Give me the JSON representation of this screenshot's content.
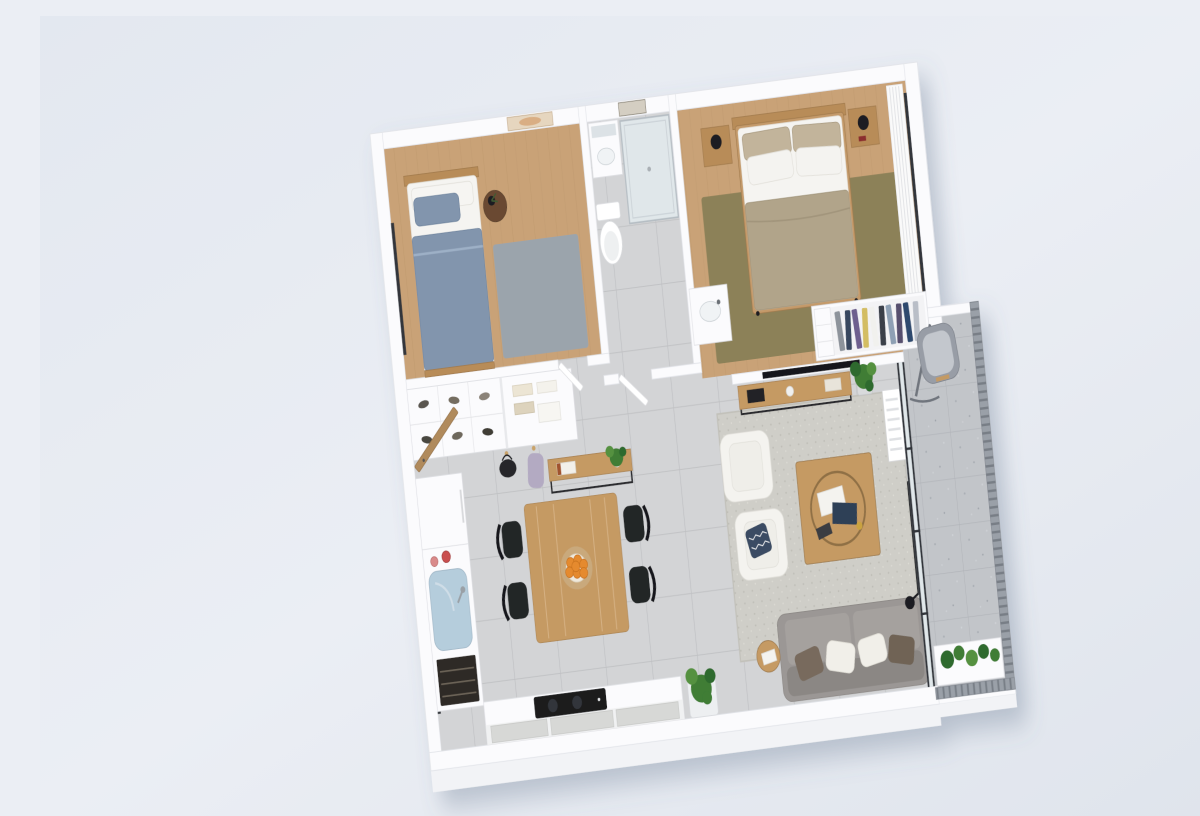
{
  "scene": {
    "description": "3D rendered isometric floor plan of a two-bedroom apartment with balcony, viewed from above on a pale blue-gray background",
    "view": "top-down axonometric, plan rotated slightly counter-clockwise",
    "rooms": [
      {
        "name": "Small bedroom",
        "position": "top-left",
        "floor": "light wood",
        "contents": [
          "single bed with blue-gray blanket and pillow",
          "wood headboard",
          "round dark-wood side table with black vase plant",
          "gray area rug",
          "beige wall art print",
          "window on left wall"
        ]
      },
      {
        "name": "Bathroom",
        "position": "top-center",
        "floor": "gray tile",
        "contents": [
          "white vanity with mirror",
          "glass shower enclosure",
          "white toilet",
          "washbasin cabinet open to hallway",
          "framed picture",
          "white door ajar"
        ]
      },
      {
        "name": "Master bedroom",
        "position": "top-right",
        "floor": "light wood",
        "contents": [
          "double bed with taupe blanket, beige and white pillows",
          "wood headboard",
          "two wood nightstands with black sphere lamps",
          "olive-green area rug",
          "white curtains over right window",
          "open wardrobe with hanging clothes"
        ]
      },
      {
        "name": "Entry hall",
        "position": "center-left",
        "floor": "gray tile",
        "contents": [
          "open shoe cabinet with shoes",
          "shelf with folded clothes",
          "coat hooks with black bag and lavender jacket",
          "wood entry door ajar",
          "two-tier console shelf with plant and books"
        ]
      },
      {
        "name": "Kitchen",
        "position": "bottom-left",
        "floor": "gray tile",
        "contents": [
          "tall white cabinet (fridge)",
          "counter with large light-blue sink",
          "red pots",
          "dark oven stack",
          "bottom counter with black cooktop and gray cabinet fronts",
          "windows on left wall"
        ]
      },
      {
        "name": "Dining area",
        "position": "bottom-center-left",
        "floor": "gray tile",
        "contents": [
          "rectangular wood dining table",
          "four black chairs",
          "plate of oranges on woven placemat"
        ]
      },
      {
        "name": "Living room",
        "position": "bottom-right",
        "floor": "gray tile",
        "contents": [
          "light-gray textured rug",
          "two white armchairs",
          "navy patterned pillow",
          "square wood coffee table with round tray and magazines",
          "gray sofa with brown and white pillows",
          "round wood side table",
          "TV on partition wall",
          "wood media console",
          "white radiator",
          "black floor lamp",
          "potted plants"
        ]
      },
      {
        "name": "Balcony",
        "position": "right",
        "floor": "speckled gray stone tile",
        "contents": [
          "gray hanging lounge chair",
          "white planter box with green plants",
          "gray metal slat railing",
          "dark-framed glass sliding doors"
        ]
      }
    ]
  },
  "palette": {
    "bg_top": "#e3e8f0",
    "bg_mid": "#ebeef4",
    "bg_bottom": "#dfe4ec",
    "wall": "#fbfbfd",
    "wall_edge": "#e2e4e9",
    "wall_face": "#f2f3f6",
    "cab_edge": "#e0e1e5",
    "wood_floor": "#c9a277",
    "wood_grain": "#b4placeholder",
    "tile": "#d3d4d6",
    "tile_line": "#bfc0c3",
    "balcony_tile": "#c2c5c9",
    "balcony_line": "#b0b3b8",
    "rug_gray": "#9ba4ac",
    "rug_olive": "#8c8159",
    "rug_living": "#cfcec8",
    "wood_furn": "#b88c59",
    "wood_furn_edge": "#a37c4e",
    "wood_mid": "#c59a64",
    "wood_mid_edge": "#ab8455",
    "wood_dark": "#6b4a33",
    "wood_door": "#b08a5c",
    "duvet_white": "#f5f4f1",
    "bed_blue": "#8295ad",
    "blanket_taupe": "#b1a48a",
    "pillow_beige": "#c2b49b",
    "sofa_gray": "#9b9795",
    "sofa_dark": "#8b8784",
    "pillow_brown": "#786b5d",
    "chair_white": "#f4f3ef",
    "navy": "#3a4c63",
    "plant": "#3f7d36",
    "plant_light": "#55913f",
    "plant_dark": "#2f6a2e",
    "black": "#1c1e21",
    "frame_dark": "#33363b",
    "appliance_dark": "#2e2a26",
    "orange": "#e58a2f",
    "sink_blue": "#b5cddc",
    "glass": "#e0e7ea",
    "railing": "#9aa0a8",
    "railing_dark": "#787e86",
    "cabinet_gray": "#d7d8d6",
    "shadow": "#5a6a85"
  }
}
